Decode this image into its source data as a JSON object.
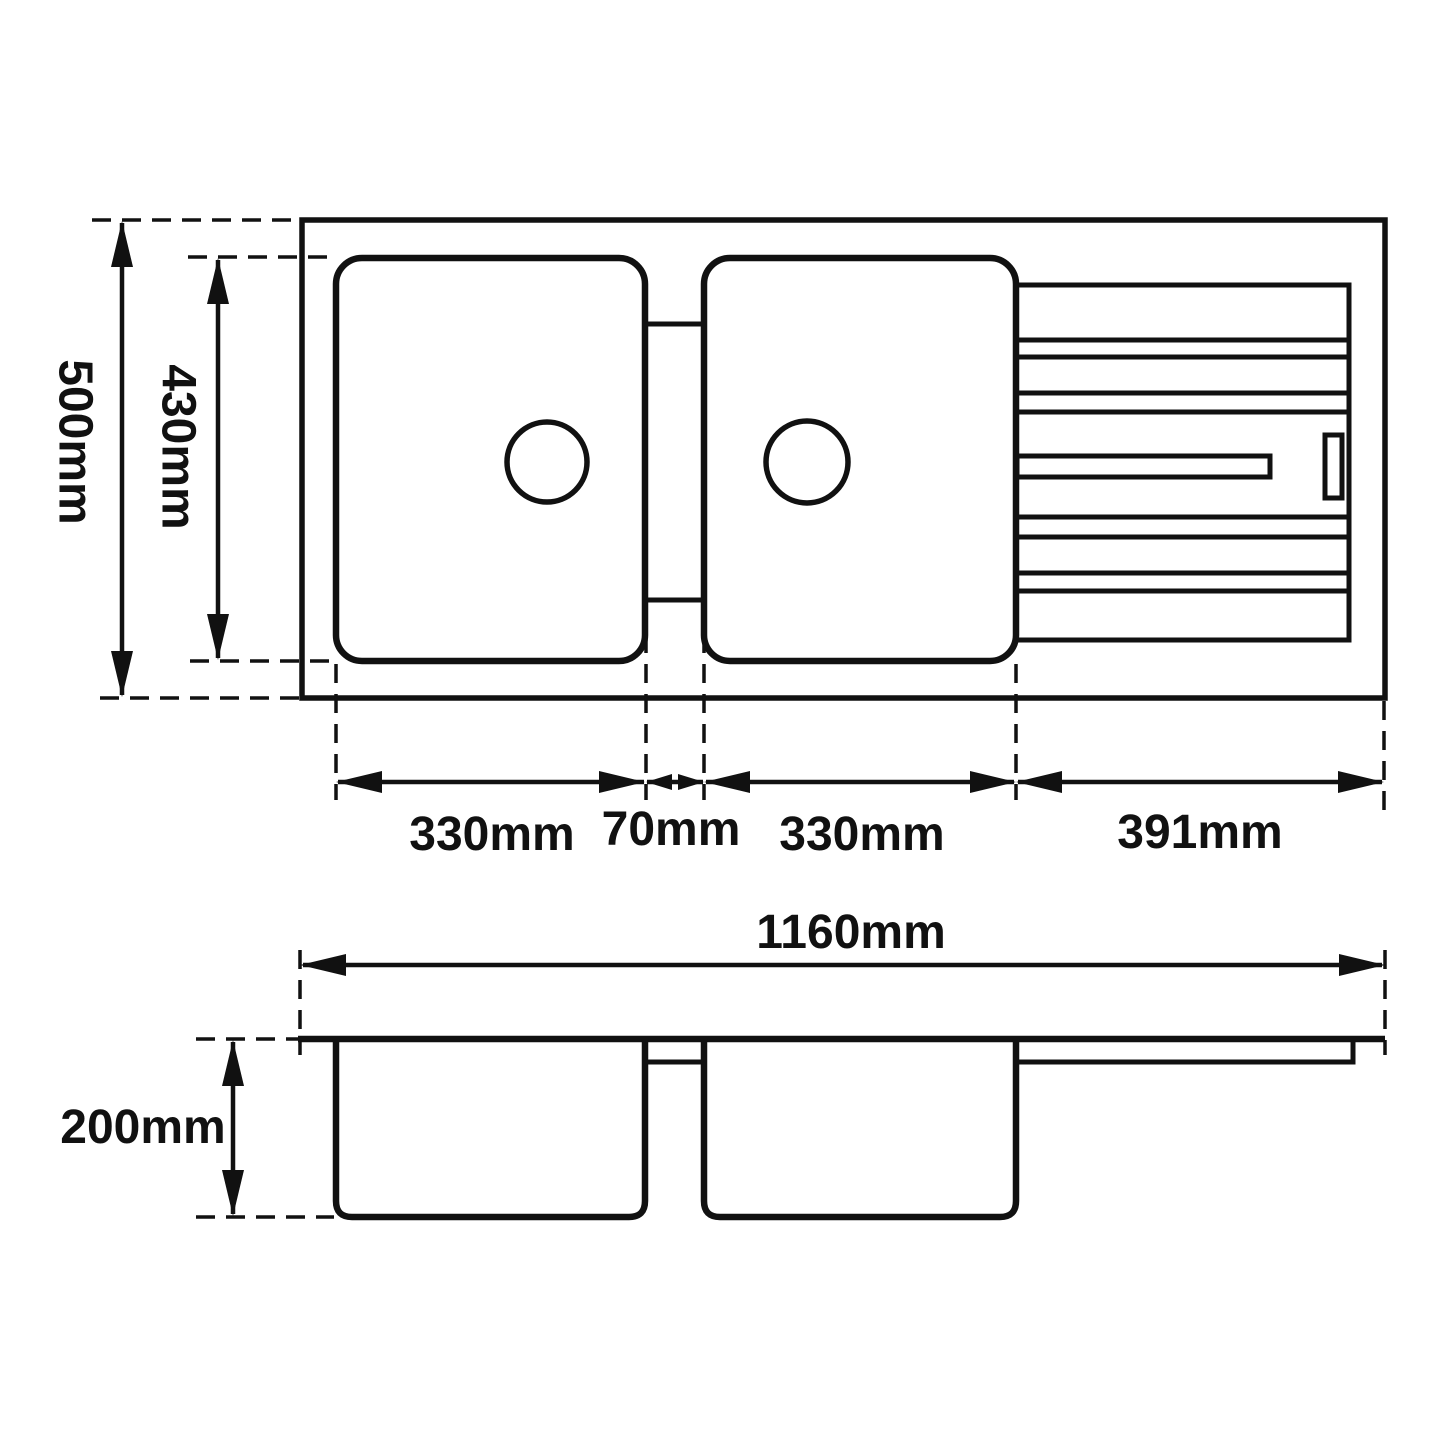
{
  "drawing": {
    "units": "mm",
    "colors": {
      "line": "#111111",
      "background": "#ffffff"
    },
    "top_view": {
      "overall_depth": "500mm",
      "bowl_depth": "430mm",
      "left_bowl_width": "330mm",
      "divider_width": "70mm",
      "right_bowl_width": "330mm",
      "drainer_width": "391mm"
    },
    "side_view": {
      "overall_length": "1160mm",
      "bowl_height": "200mm"
    }
  }
}
